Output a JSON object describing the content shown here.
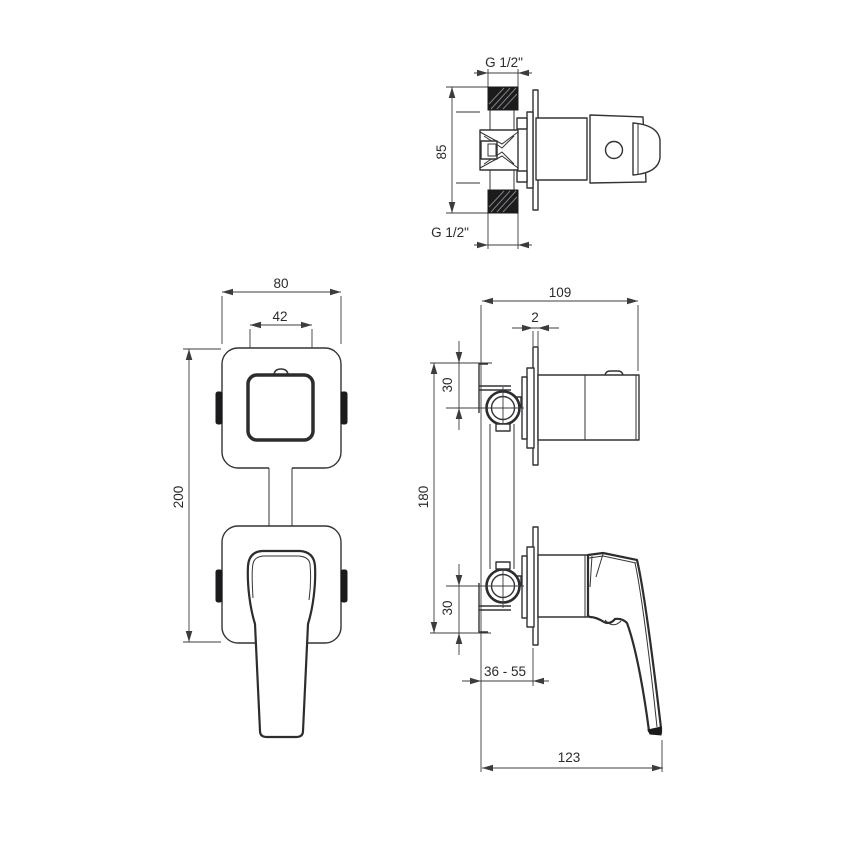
{
  "page": {
    "background": "#ffffff",
    "line_color": "#333336",
    "black_fill": "#1b1b1d"
  },
  "drawing": {
    "labels": {
      "thread_top": "G 1/2\"",
      "pipe_length": "85",
      "thread_bottom": "G 1/2\"",
      "trim_width": "80",
      "handle_base_width": "42",
      "total_height": "200",
      "body_depth": "109",
      "plate_thickness": "2",
      "offset_top": "30",
      "valve_spacing": "180",
      "offset_bottom": "30",
      "install_depth_range": "36 - 55",
      "handle_reach": "123"
    }
  }
}
